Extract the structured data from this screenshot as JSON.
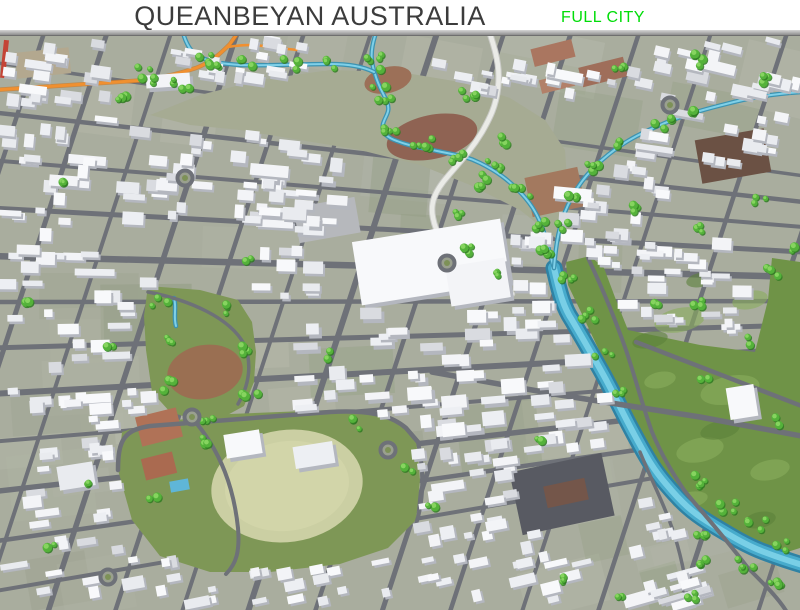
{
  "header": {
    "title": "QUEANBEYAN AUSTRALIA",
    "badge": "FULL CITY",
    "title_color": "#3c3c3c",
    "badge_color": "#00dd08"
  },
  "map": {
    "seed": 7,
    "palette": {
      "base": "#a9ad9e",
      "mosaic": [
        "#b6b9ab",
        "#9ca28f",
        "#afb3a3",
        "#94a184",
        "#b1b4a9",
        "#8f9b7f"
      ],
      "road": "#6e7178",
      "river_edge": "#2f82a4",
      "river_mid": "#47abcc",
      "river_core": "#79cfe6",
      "stream_dark": "#3d93b1",
      "stream_light": "#7fd0e8",
      "rail": "#f09030",
      "rail_dark": "#cf741c",
      "meadow": "#a6ab93",
      "golf": "#6f9347",
      "golf_light": "#8bad5d",
      "golf_dark": "#5b803b",
      "park": "#7e9756",
      "oval": "#cbcfa3",
      "tree": "#54b23a",
      "tree_dark": "#2f7a22",
      "tree_light": "#86d45f",
      "bldg_top": [
        "#f3f4f7",
        "#edeff3",
        "#f8f9fb",
        "#e9ebef"
      ],
      "bldg_roof_alt": "#d9dbe0",
      "bldg_side": "#b4b7bf",
      "white_road": "#eaebe7",
      "white_road_casing": "#c9cac6"
    },
    "grid": {
      "vp": [
        1700,
        300
      ],
      "h": [
        [
          62,
          3.5
        ],
        [
          112,
          4.5
        ],
        [
          160,
          4
        ],
        [
          208,
          5
        ],
        [
          256,
          6.5
        ],
        [
          302,
          4.5
        ],
        [
          348,
          5
        ],
        [
          394,
          6
        ],
        [
          442,
          4
        ],
        [
          492,
          5.5
        ],
        [
          542,
          4.5
        ],
        [
          592,
          4
        ]
      ],
      "v_slope": 0.33,
      "v": [
        [
          -15,
          4
        ],
        [
          45,
          4.5
        ],
        [
          108,
          5
        ],
        [
          172,
          4
        ],
        [
          238,
          5.5
        ],
        [
          305,
          4.5
        ],
        [
          372,
          4
        ],
        [
          438,
          6
        ],
        [
          505,
          4.5
        ],
        [
          572,
          5
        ],
        [
          640,
          4.5
        ],
        [
          712,
          4
        ],
        [
          788,
          4.5
        ],
        [
          868,
          5
        ],
        [
          948,
          4
        ]
      ]
    },
    "water": {
      "river_d": "M554,268 C560,295 564,308 572,320 C586,344 594,358 604,376 C616,398 622,412 634,434 C648,460 654,470 666,484 C682,503 692,512 708,522 C734,538 748,546 764,552 C780,558 792,562 806,566",
      "river_pts": [
        [
          554,
          268
        ],
        [
          565,
          298
        ],
        [
          578,
          324
        ],
        [
          592,
          352
        ],
        [
          606,
          378
        ],
        [
          622,
          408
        ],
        [
          638,
          438
        ],
        [
          654,
          466
        ],
        [
          670,
          488
        ],
        [
          690,
          508
        ],
        [
          712,
          524
        ],
        [
          738,
          542
        ],
        [
          764,
          553
        ],
        [
          790,
          562
        ]
      ],
      "streams": [
        "M375,36 C370,52 371,62 375,74 C379,88 384,94 387,102 C391,112 385,116 383,124 C381,133 388,138 397,141 C412,147 424,148 437,151 C456,155 466,156 480,163 C498,172 508,180 518,190 C530,202 536,212 541,224 C547,239 549,252 554,268",
        "M184,36 C188,48 193,54 202,58 C214,63 226,64 240,65 C268,66 300,64 330,64 C348,64 362,66 374,72",
        "M802,92 C770,94 748,98 726,104 C698,111 678,117 658,126 C634,136 618,146 602,160 C586,174 576,188 568,205 C559,224 556,244 554,268",
        "M174,298 C177,308 173,316 176,326"
      ]
    },
    "rail": {
      "main": "M-6,90 L148,80 C170,76 184,72 196,68 C212,62 222,52 230,44 L237,34",
      "branch": "M228,47 C246,44 258,45 270,47 L306,51"
    },
    "greens": {
      "meadow": [
        150,
        115,
        200,
        95,
        260,
        80,
        330,
        70,
        400,
        72,
        460,
        82,
        510,
        98,
        545,
        120,
        565,
        150,
        568,
        195,
        558,
        240,
        520,
        210,
        470,
        185,
        420,
        165,
        360,
        150,
        300,
        140,
        240,
        130,
        190,
        125
      ],
      "golf": [
        566,
        262,
        590,
        256,
        604,
        268,
        616,
        300,
        628,
        330,
        700,
        345,
        755,
        352,
        768,
        300,
        772,
        258,
        800,
        262,
        800,
        548,
        762,
        560,
        726,
        540,
        696,
        516,
        668,
        488,
        646,
        458,
        630,
        424,
        614,
        388,
        598,
        348,
        580,
        310,
        568,
        285
      ],
      "park": [
        118,
        470,
        122,
        432,
        150,
        423,
        230,
        414,
        330,
        410,
        372,
        414,
        402,
        424,
        416,
        440,
        420,
        480,
        416,
        520,
        388,
        548,
        340,
        564,
        270,
        572,
        210,
        572,
        160,
        556,
        132,
        520
      ],
      "park2": [
        148,
        286,
        200,
        290,
        238,
        300,
        252,
        322,
        256,
        352,
        254,
        382,
        244,
        406,
        222,
        418,
        196,
        420,
        170,
        412,
        152,
        392,
        146,
        350,
        144,
        316
      ],
      "oval": {
        "cx": 287,
        "cy": 486,
        "rx": 76,
        "ry": 56,
        "rot": -8
      },
      "oval2": {
        "cx": 205,
        "cy": 372,
        "rx": 38,
        "ry": 27,
        "rot": -10,
        "color": "#9a6f52"
      },
      "golf_light_spots": [
        [
          680,
          320,
          26,
          12
        ],
        [
          730,
          390,
          30,
          14
        ],
        [
          700,
          450,
          24,
          12
        ],
        [
          770,
          470,
          20,
          10
        ],
        [
          750,
          300,
          18,
          9
        ],
        [
          660,
          380,
          16,
          8
        ],
        [
          690,
          500,
          18,
          8
        ]
      ],
      "golf_dark_spots": [
        [
          650,
          340,
          18,
          8
        ],
        [
          720,
          430,
          20,
          9
        ],
        [
          760,
          520,
          16,
          8
        ],
        [
          700,
          280,
          14,
          7
        ]
      ]
    },
    "dirt": [
      {
        "x": 388,
        "y": 80,
        "w": 48,
        "h": 26,
        "r": -14,
        "c": "#9c7058",
        "s": "ell"
      },
      {
        "x": 432,
        "y": 137,
        "w": 92,
        "h": 44,
        "r": -12,
        "c": "#8f6353",
        "s": "ell"
      },
      {
        "x": 532,
        "y": 44,
        "w": 42,
        "h": 18,
        "r": -14,
        "c": "#aa7660",
        "s": "rect"
      },
      {
        "x": 580,
        "y": 62,
        "w": 46,
        "h": 20,
        "r": -14,
        "c": "#9f6e5a",
        "s": "rect"
      },
      {
        "x": 540,
        "y": 76,
        "w": 34,
        "h": 14,
        "r": -14,
        "c": "#b28069",
        "s": "rect"
      },
      {
        "x": 528,
        "y": 172,
        "w": 54,
        "h": 40,
        "r": -12,
        "c": "#a3795f",
        "s": "rect"
      },
      {
        "x": 698,
        "y": 134,
        "w": 70,
        "h": 44,
        "r": -10,
        "c": "#6b5144",
        "s": "rect"
      },
      {
        "x": 515,
        "y": 462,
        "w": 94,
        "h": 64,
        "r": -12,
        "c": "#585a62",
        "s": "rect"
      },
      {
        "x": 545,
        "y": 482,
        "w": 42,
        "h": 22,
        "r": -12,
        "c": "#74564a",
        "s": "rect"
      },
      {
        "x": 138,
        "y": 412,
        "w": 42,
        "h": 30,
        "r": -14,
        "c": "#b07257",
        "s": "rect"
      },
      {
        "x": 143,
        "y": 455,
        "w": 32,
        "h": 22,
        "r": -14,
        "c": "#aa6a50",
        "s": "rect"
      },
      {
        "x": 16,
        "y": 50,
        "w": 54,
        "h": 26,
        "r": -6,
        "c": "#b3a88f",
        "s": "rect"
      },
      {
        "x": 296,
        "y": 202,
        "w": 62,
        "h": 36,
        "r": -10,
        "c": "#b6b8bc",
        "s": "rect"
      },
      {
        "x": 170,
        "y": 480,
        "w": 19,
        "h": 11,
        "r": -10,
        "c": "#5fb6d8",
        "s": "rect"
      },
      {
        "x": 2,
        "y": 40,
        "w": 5,
        "h": 38,
        "r": 6,
        "c": "#c44436",
        "s": "rect"
      }
    ],
    "white_road": "M490,34 C498,58 500,72 498,88 C496,106 490,118 482,132 C470,152 458,164 448,176 C434,192 430,204 433,218 C436,234 444,244 456,254 C470,265 482,271 494,279 C502,284 508,289 512,294",
    "feature_roads": [
      {
        "d": "M432,372 L560,395 L700,417 L812,438",
        "w": 5.5
      },
      {
        "d": "M588,258 C606,296 616,322 626,350 C636,380 642,404 652,432 C662,456 672,472 684,490 C698,508 714,524 748,568 C768,588 780,600 788,614",
        "w": 4
      },
      {
        "d": "M640,452 C648,472 658,492 666,512 C676,536 682,560 686,584 L688,614",
        "w": 3.5
      },
      {
        "d": "M636,342 L812,410",
        "w": 4.5
      },
      {
        "d": "M118,470 C118,440 124,430 150,426 L330,412 C366,410 390,414 406,428 L418,442",
        "w": 4.5
      },
      {
        "d": "M418,442 C424,470 424,500 416,524",
        "w": 4
      },
      {
        "d": "M192,418 C222,452 234,490 238,528 C240,552 236,564 226,574",
        "w": 4
      },
      {
        "d": "M540,464 L448,477",
        "w": 3.5
      },
      {
        "d": "M148,292 C190,300 230,318 244,344 C252,362 250,384 238,404",
        "w": 3.5
      }
    ],
    "big_buildings": [
      [
        356,
        230,
        150,
        64,
        -9
      ],
      [
        448,
        262,
        60,
        40,
        -9
      ],
      [
        728,
        386,
        28,
        32,
        -9
      ],
      [
        146,
        74,
        44,
        13,
        -4
      ],
      [
        225,
        432,
        36,
        24,
        -9
      ],
      [
        58,
        464,
        36,
        24,
        -9
      ],
      [
        294,
        444,
        40,
        22,
        -9
      ]
    ],
    "zones": [
      [
        4,
        42,
        120,
        66,
        18,
        1
      ],
      [
        140,
        44,
        80,
        40,
        8,
        0.9
      ],
      [
        232,
        40,
        84,
        28,
        6,
        0.9
      ],
      [
        236,
        62,
        80,
        28,
        6,
        0.9
      ],
      [
        436,
        58,
        100,
        80,
        13,
        0.85
      ],
      [
        548,
        42,
        100,
        52,
        8,
        0.95
      ],
      [
        656,
        40,
        140,
        66,
        20,
        1
      ],
      [
        620,
        112,
        175,
        55,
        18,
        1
      ],
      [
        548,
        148,
        115,
        75,
        14,
        1
      ],
      [
        4,
        118,
        140,
        108,
        24,
        1.05
      ],
      [
        4,
        232,
        145,
        195,
        42,
        1.05
      ],
      [
        152,
        118,
        150,
        108,
        26,
        1
      ],
      [
        234,
        152,
        120,
        82,
        22,
        1.1
      ],
      [
        300,
        305,
        215,
        130,
        42,
        1.15
      ],
      [
        515,
        235,
        95,
        110,
        20,
        1
      ],
      [
        540,
        355,
        80,
        95,
        15,
        1
      ],
      [
        604,
        234,
        150,
        98,
        32,
        0.95
      ],
      [
        4,
        434,
        130,
        170,
        26,
        1
      ],
      [
        146,
        556,
        250,
        50,
        20,
        0.95
      ],
      [
        402,
        442,
        150,
        110,
        28,
        1
      ],
      [
        412,
        556,
        170,
        50,
        16,
        0.95
      ],
      [
        636,
        500,
        72,
        104,
        13,
        0.95
      ],
      [
        648,
        582,
        90,
        26,
        8,
        0.9
      ],
      [
        255,
        250,
        60,
        50,
        9,
        1.05
      ]
    ],
    "tree_clusters": [
      [
        378,
        60,
        5,
        14
      ],
      [
        383,
        95,
        5,
        12
      ],
      [
        390,
        125,
        4,
        10
      ],
      [
        420,
        145,
        5,
        12
      ],
      [
        455,
        155,
        4,
        10
      ],
      [
        490,
        168,
        5,
        12
      ],
      [
        520,
        190,
        4,
        10
      ],
      [
        540,
        225,
        4,
        10
      ],
      [
        548,
        255,
        4,
        10
      ],
      [
        205,
        58,
        3,
        8
      ],
      [
        245,
        64,
        3,
        8
      ],
      [
        290,
        64,
        3,
        8
      ],
      [
        332,
        64,
        3,
        8
      ],
      [
        700,
        112,
        4,
        10
      ],
      [
        662,
        124,
        4,
        10
      ],
      [
        626,
        142,
        4,
        10
      ],
      [
        596,
        164,
        4,
        10
      ],
      [
        572,
        200,
        3,
        8
      ],
      [
        562,
        228,
        3,
        8
      ],
      [
        565,
        282,
        4,
        10
      ],
      [
        585,
        315,
        4,
        10
      ],
      [
        603,
        352,
        3,
        9
      ],
      [
        622,
        392,
        3,
        8
      ],
      [
        700,
        480,
        4,
        10
      ],
      [
        726,
        506,
        4,
        10
      ],
      [
        756,
        526,
        4,
        10
      ],
      [
        784,
        546,
        3,
        8
      ],
      [
        702,
        532,
        3,
        8
      ],
      [
        744,
        566,
        4,
        10
      ],
      [
        772,
        588,
        4,
        12
      ],
      [
        706,
        560,
        3,
        9
      ],
      [
        690,
        594,
        3,
        9
      ],
      [
        470,
        95,
        4,
        10
      ],
      [
        502,
        140,
        3,
        8
      ],
      [
        480,
        185,
        3,
        8
      ],
      [
        458,
        215,
        3,
        8
      ],
      [
        472,
        250,
        3,
        8
      ],
      [
        502,
        272,
        3,
        8
      ],
      [
        145,
        75,
        5,
        14
      ],
      [
        180,
        86,
        4,
        10
      ],
      [
        215,
        68,
        3,
        8
      ],
      [
        120,
        100,
        3,
        8
      ],
      [
        692,
        300,
        3,
        10
      ],
      [
        742,
        342,
        2,
        8
      ],
      [
        782,
        420,
        2,
        8
      ],
      [
        704,
        382,
        2,
        8
      ],
      [
        654,
        302,
        2,
        6
      ],
      [
        772,
        270,
        3,
        9
      ],
      [
        200,
        440,
        3,
        8
      ],
      [
        356,
        424,
        3,
        8
      ],
      [
        410,
        470,
        2,
        6
      ],
      [
        152,
        500,
        2,
        6
      ],
      [
        160,
        300,
        3,
        8
      ],
      [
        230,
        310,
        3,
        8
      ],
      [
        170,
        340,
        3,
        8
      ],
      [
        245,
        350,
        3,
        8
      ],
      [
        165,
        385,
        3,
        8
      ],
      [
        250,
        395,
        3,
        8
      ],
      [
        205,
        415,
        4,
        10
      ],
      [
        60,
        180,
        2,
        6
      ],
      [
        30,
        300,
        2,
        6
      ],
      [
        110,
        350,
        2,
        6
      ],
      [
        90,
        480,
        2,
        6
      ],
      [
        50,
        545,
        2,
        6
      ],
      [
        330,
        355,
        2,
        6
      ],
      [
        250,
        260,
        2,
        6
      ],
      [
        540,
        440,
        2,
        6
      ],
      [
        430,
        505,
        2,
        6
      ],
      [
        560,
        580,
        3,
        8
      ],
      [
        618,
        598,
        2,
        6
      ],
      [
        640,
        210,
        3,
        8
      ],
      [
        700,
        228,
        3,
        8
      ],
      [
        760,
        200,
        3,
        8
      ],
      [
        790,
        250,
        2,
        6
      ],
      [
        622,
        70,
        3,
        8
      ],
      [
        700,
        60,
        4,
        10
      ],
      [
        770,
        80,
        3,
        8
      ]
    ],
    "roundabouts": [
      [
        185,
        178
      ],
      [
        447,
        263
      ],
      [
        670,
        105
      ],
      [
        388,
        450
      ],
      [
        192,
        417
      ],
      [
        108,
        577
      ]
    ]
  }
}
